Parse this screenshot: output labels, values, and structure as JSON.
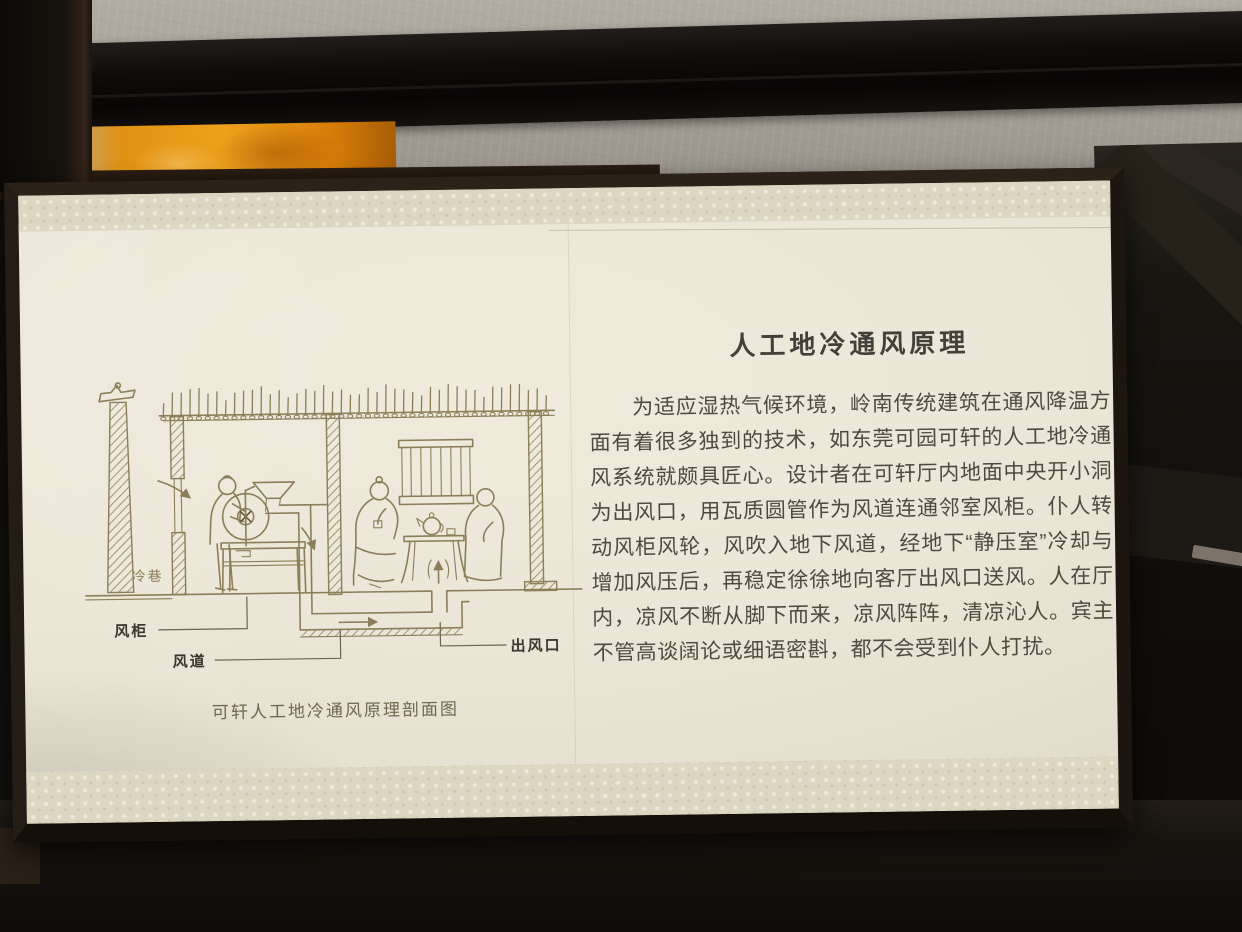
{
  "panel": {
    "title": "人工地冷通风原理",
    "body": "为适应湿热气候环境，岭南传统建筑在通风降温方面有着很多独到的技术，如东莞可园可轩的人工地冷通风系统就颇具匠心。设计者在可轩厅内地面中央开小洞为出风口，用瓦质圆管作为风道连通邻室风柜。仆人转动风柜风轮，风吹入地下风道，经地下“静压室”冷却与增加风压后，再稳定徐徐地向客厅出风口送风。人在厅内，凉风不断从脚下而来，凉风阵阵，清凉沁人。宾主不管高谈阔论或细语密斟，都不会受到仆人打扰。",
    "diagram": {
      "caption": "可轩人工地冷通风原理剖面图",
      "labels": {
        "cold_alley": "冷巷",
        "wind_cabinet": "风柜",
        "air_duct": "风道",
        "air_outlet": "出风口"
      }
    },
    "colors": {
      "frame": "#241c15",
      "board_face": "#ebe6d7",
      "pattern_band": "#ddd7c1",
      "drawing_line": "#8c7e58",
      "label_ink": "#3c372e",
      "body_ink": "#4e4a42",
      "title_ink": "#43403a",
      "caption_ink": "#6f674e"
    }
  }
}
